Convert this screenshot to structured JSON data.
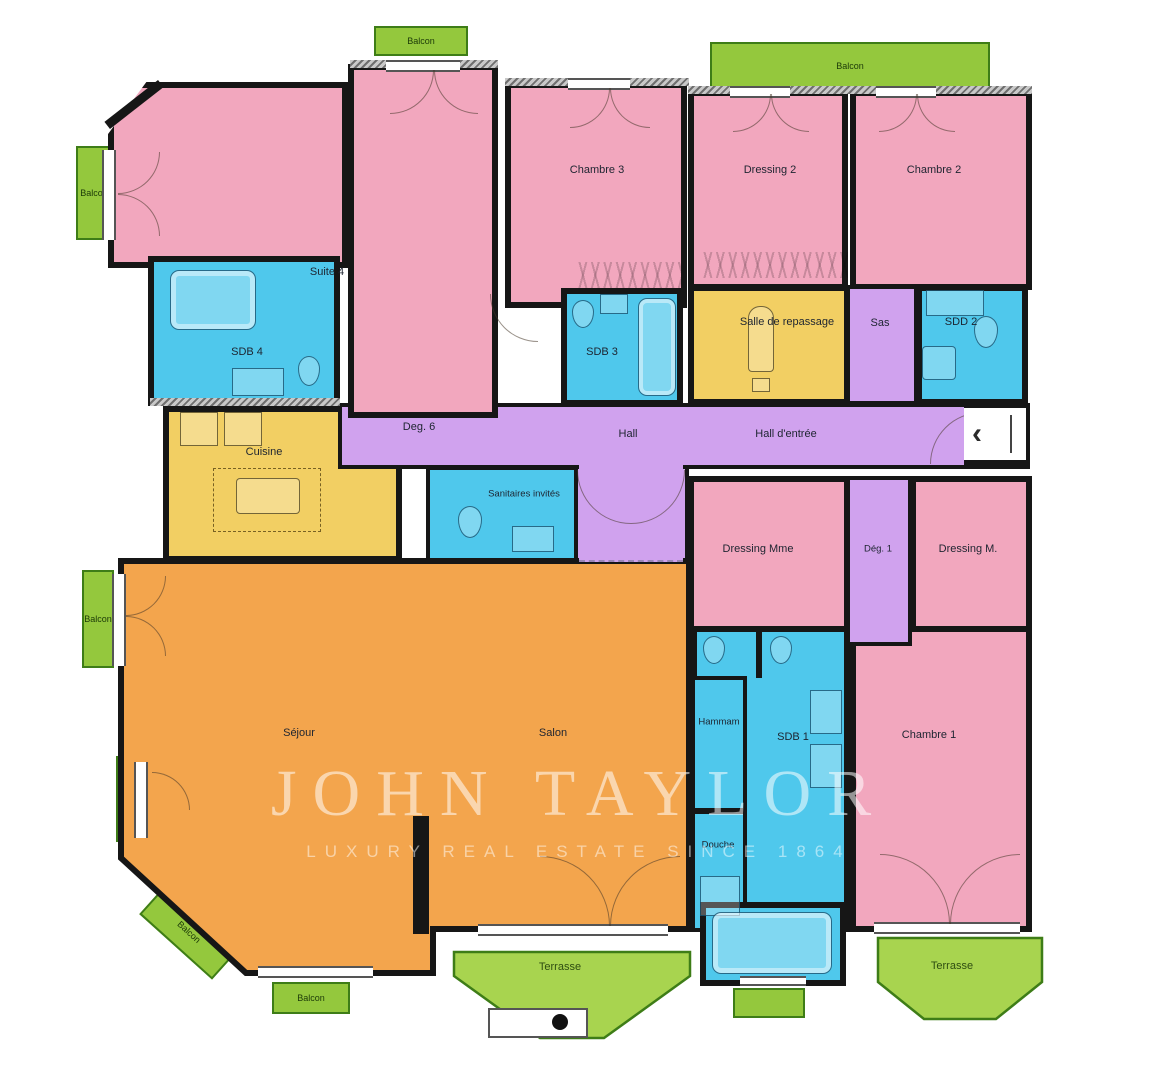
{
  "plan": {
    "rooms": {
      "suite4": "Suite 4",
      "sdb4": "SDB 4",
      "chambre3": "Chambre 3",
      "sdb3": "SDB 3",
      "dressing2": "Dressing 2",
      "chambre2": "Chambre 2",
      "salle_repassage": "Salle de repassage",
      "sas": "Sas",
      "sdd2": "SDD 2",
      "deg6": "Deg. 6",
      "hall": "Hall",
      "hall_entree": "Hall d'entrée",
      "cuisine": "Cuisine",
      "sanitaires": "Sanitaires invités",
      "dressing_mme": "Dressing Mme",
      "deg1": "Dég. 1",
      "dressing_m": "Dressing M.",
      "sejour": "Séjour",
      "salon": "Salon",
      "hammam": "Hammam",
      "sdb1": "SDB 1",
      "douche": "Douche",
      "chambre1": "Chambre 1"
    },
    "outdoor": {
      "balcon": "Balcon",
      "terrasse": "Terrasse"
    },
    "entrance": {
      "chevron": "‹"
    },
    "watermark": {
      "line1": "JOHN TAYLOR",
      "line2": "LUXURY REAL ESTATE SINCE 1864"
    },
    "colors": {
      "bedroom": "#F2A7BE",
      "bath": "#4FC8EC",
      "kitchen": "#F2CF63",
      "hall": "#D0A2EE",
      "living": "#F3A54D",
      "balcony": "#94C83D",
      "balconyBorder": "#3E7D17",
      "terrace": "#A8D44F",
      "wall": "#161616",
      "label": "#1d2430"
    }
  }
}
